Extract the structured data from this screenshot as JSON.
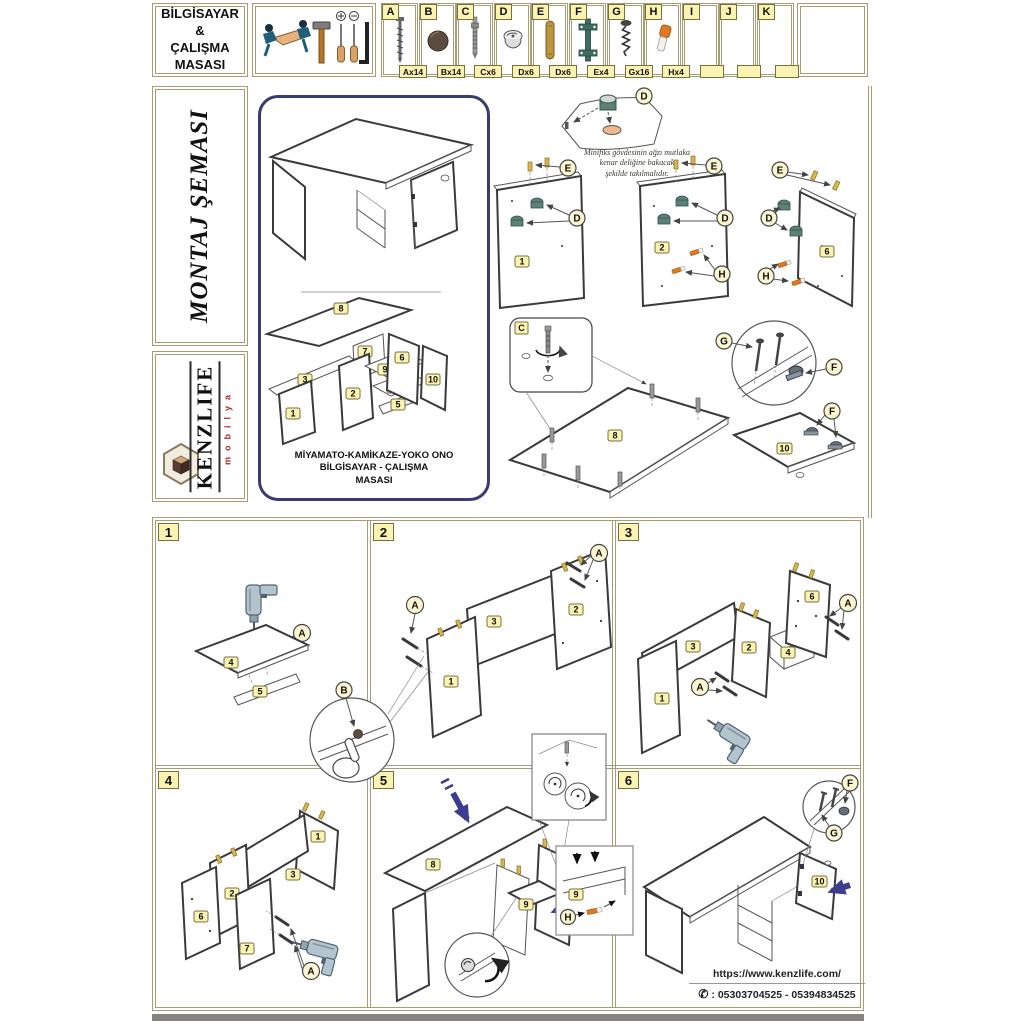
{
  "header": {
    "title": "BİLGİSAYAR\n&\nÇALIŞMA\nMASASI",
    "hardware": [
      {
        "letter": "A",
        "qty": "Ax14",
        "icon": "confirmat-screw-icon"
      },
      {
        "letter": "B",
        "qty": "Bx14",
        "icon": "cover-cap-icon"
      },
      {
        "letter": "C",
        "qty": "Cx6",
        "icon": "minifix-bolt-icon"
      },
      {
        "letter": "D",
        "qty": "Dx6",
        "icon": "minifix-cam-icon"
      },
      {
        "letter": "E",
        "qty": "Dx6",
        "icon": "wooden-dowel-icon"
      },
      {
        "letter": "F",
        "qty": "Ex4",
        "icon": "hinge-icon"
      },
      {
        "letter": "G",
        "qty": "Gx16",
        "icon": "chipboard-screw-icon"
      },
      {
        "letter": "H",
        "qty": "Hx4",
        "icon": "shelf-pin-icon"
      },
      {
        "letter": "I",
        "qty": "",
        "icon": ""
      },
      {
        "letter": "J",
        "qty": "",
        "icon": ""
      },
      {
        "letter": "K",
        "qty": "",
        "icon": ""
      }
    ]
  },
  "sidebar": {
    "montaj": "MONTAJ ŞEMASI",
    "brand": "KENZLIFE",
    "brand_sub": "mobilya"
  },
  "overview": {
    "product_name": "MİYAMATO-KAMİKAZE-YOKO ONO\nBİLGİSAYAR - ÇALIŞMA\nMASASI"
  },
  "notes": {
    "minifix": "Minifiks gövdesinin ağzı mutlaka\nkenar deliğine bakacak\nşekilde takılmalıdır."
  },
  "parts": {
    "1": "1",
    "2": "2",
    "3": "3",
    "4": "4",
    "5": "5",
    "6": "6",
    "7": "7",
    "8": "8",
    "9": "9",
    "10": "10"
  },
  "callouts": {
    "A": "A",
    "B": "B",
    "C": "C",
    "D": "D",
    "E": "E",
    "F": "F",
    "G": "G",
    "H": "H"
  },
  "steps": [
    "1",
    "2",
    "3",
    "4",
    "5",
    "6"
  ],
  "footer": {
    "url": "https://www.kenzlife.com/",
    "phone_glyph": "✆",
    "phones": ": 05303704525 - 05394834525"
  }
}
